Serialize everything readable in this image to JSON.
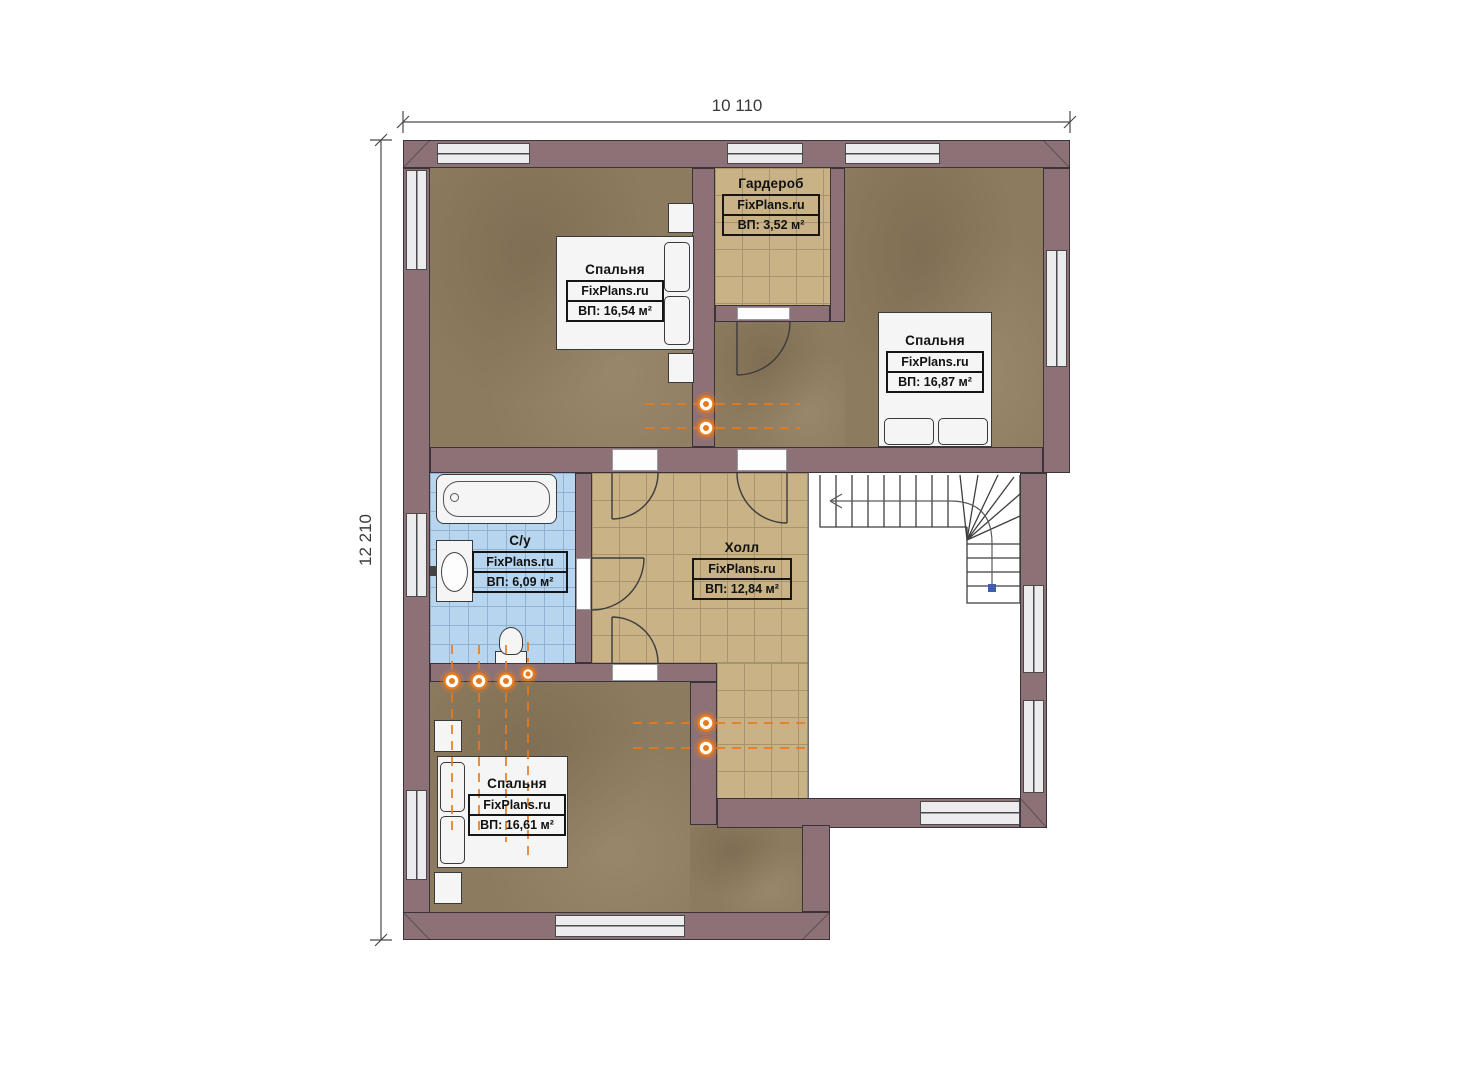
{
  "dimensions": {
    "width": "10 110",
    "height": "12 210"
  },
  "rooms": [
    {
      "key": "bedroom-top-left",
      "name": "Спальня",
      "brand": "FixPlans.ru",
      "area": "ВП: 16,54 м²"
    },
    {
      "key": "wardrobe",
      "name": "Гардероб",
      "brand": "FixPlans.ru",
      "area": "ВП: 3,52 м²"
    },
    {
      "key": "bedroom-top-right",
      "name": "Спальня",
      "brand": "FixPlans.ru",
      "area": "ВП: 16,87 м²"
    },
    {
      "key": "bathroom",
      "name": "С/у",
      "brand": "FixPlans.ru",
      "area": "ВП: 6,09 м²"
    },
    {
      "key": "hall",
      "name": "Холл",
      "brand": "FixPlans.ru",
      "area": "ВП: 12,84 м²"
    },
    {
      "key": "bedroom-bottom",
      "name": "Спальня",
      "brand": "FixPlans.ru",
      "area": "ВП: 16,61 м²"
    }
  ],
  "colors": {
    "wall": "#8c7277",
    "wall_line": "#3b3338",
    "wood": "#8d7b5f",
    "tile": "#c8b286",
    "tile_line": "#a5946d",
    "bath": "#b7d5ee",
    "bath_line": "#8fb2d2",
    "window_fill": "#ececef",
    "frame": "#4a4a4a",
    "heat": "#e87a1e",
    "ink": "#111111",
    "walknode": "#3f5fae"
  }
}
